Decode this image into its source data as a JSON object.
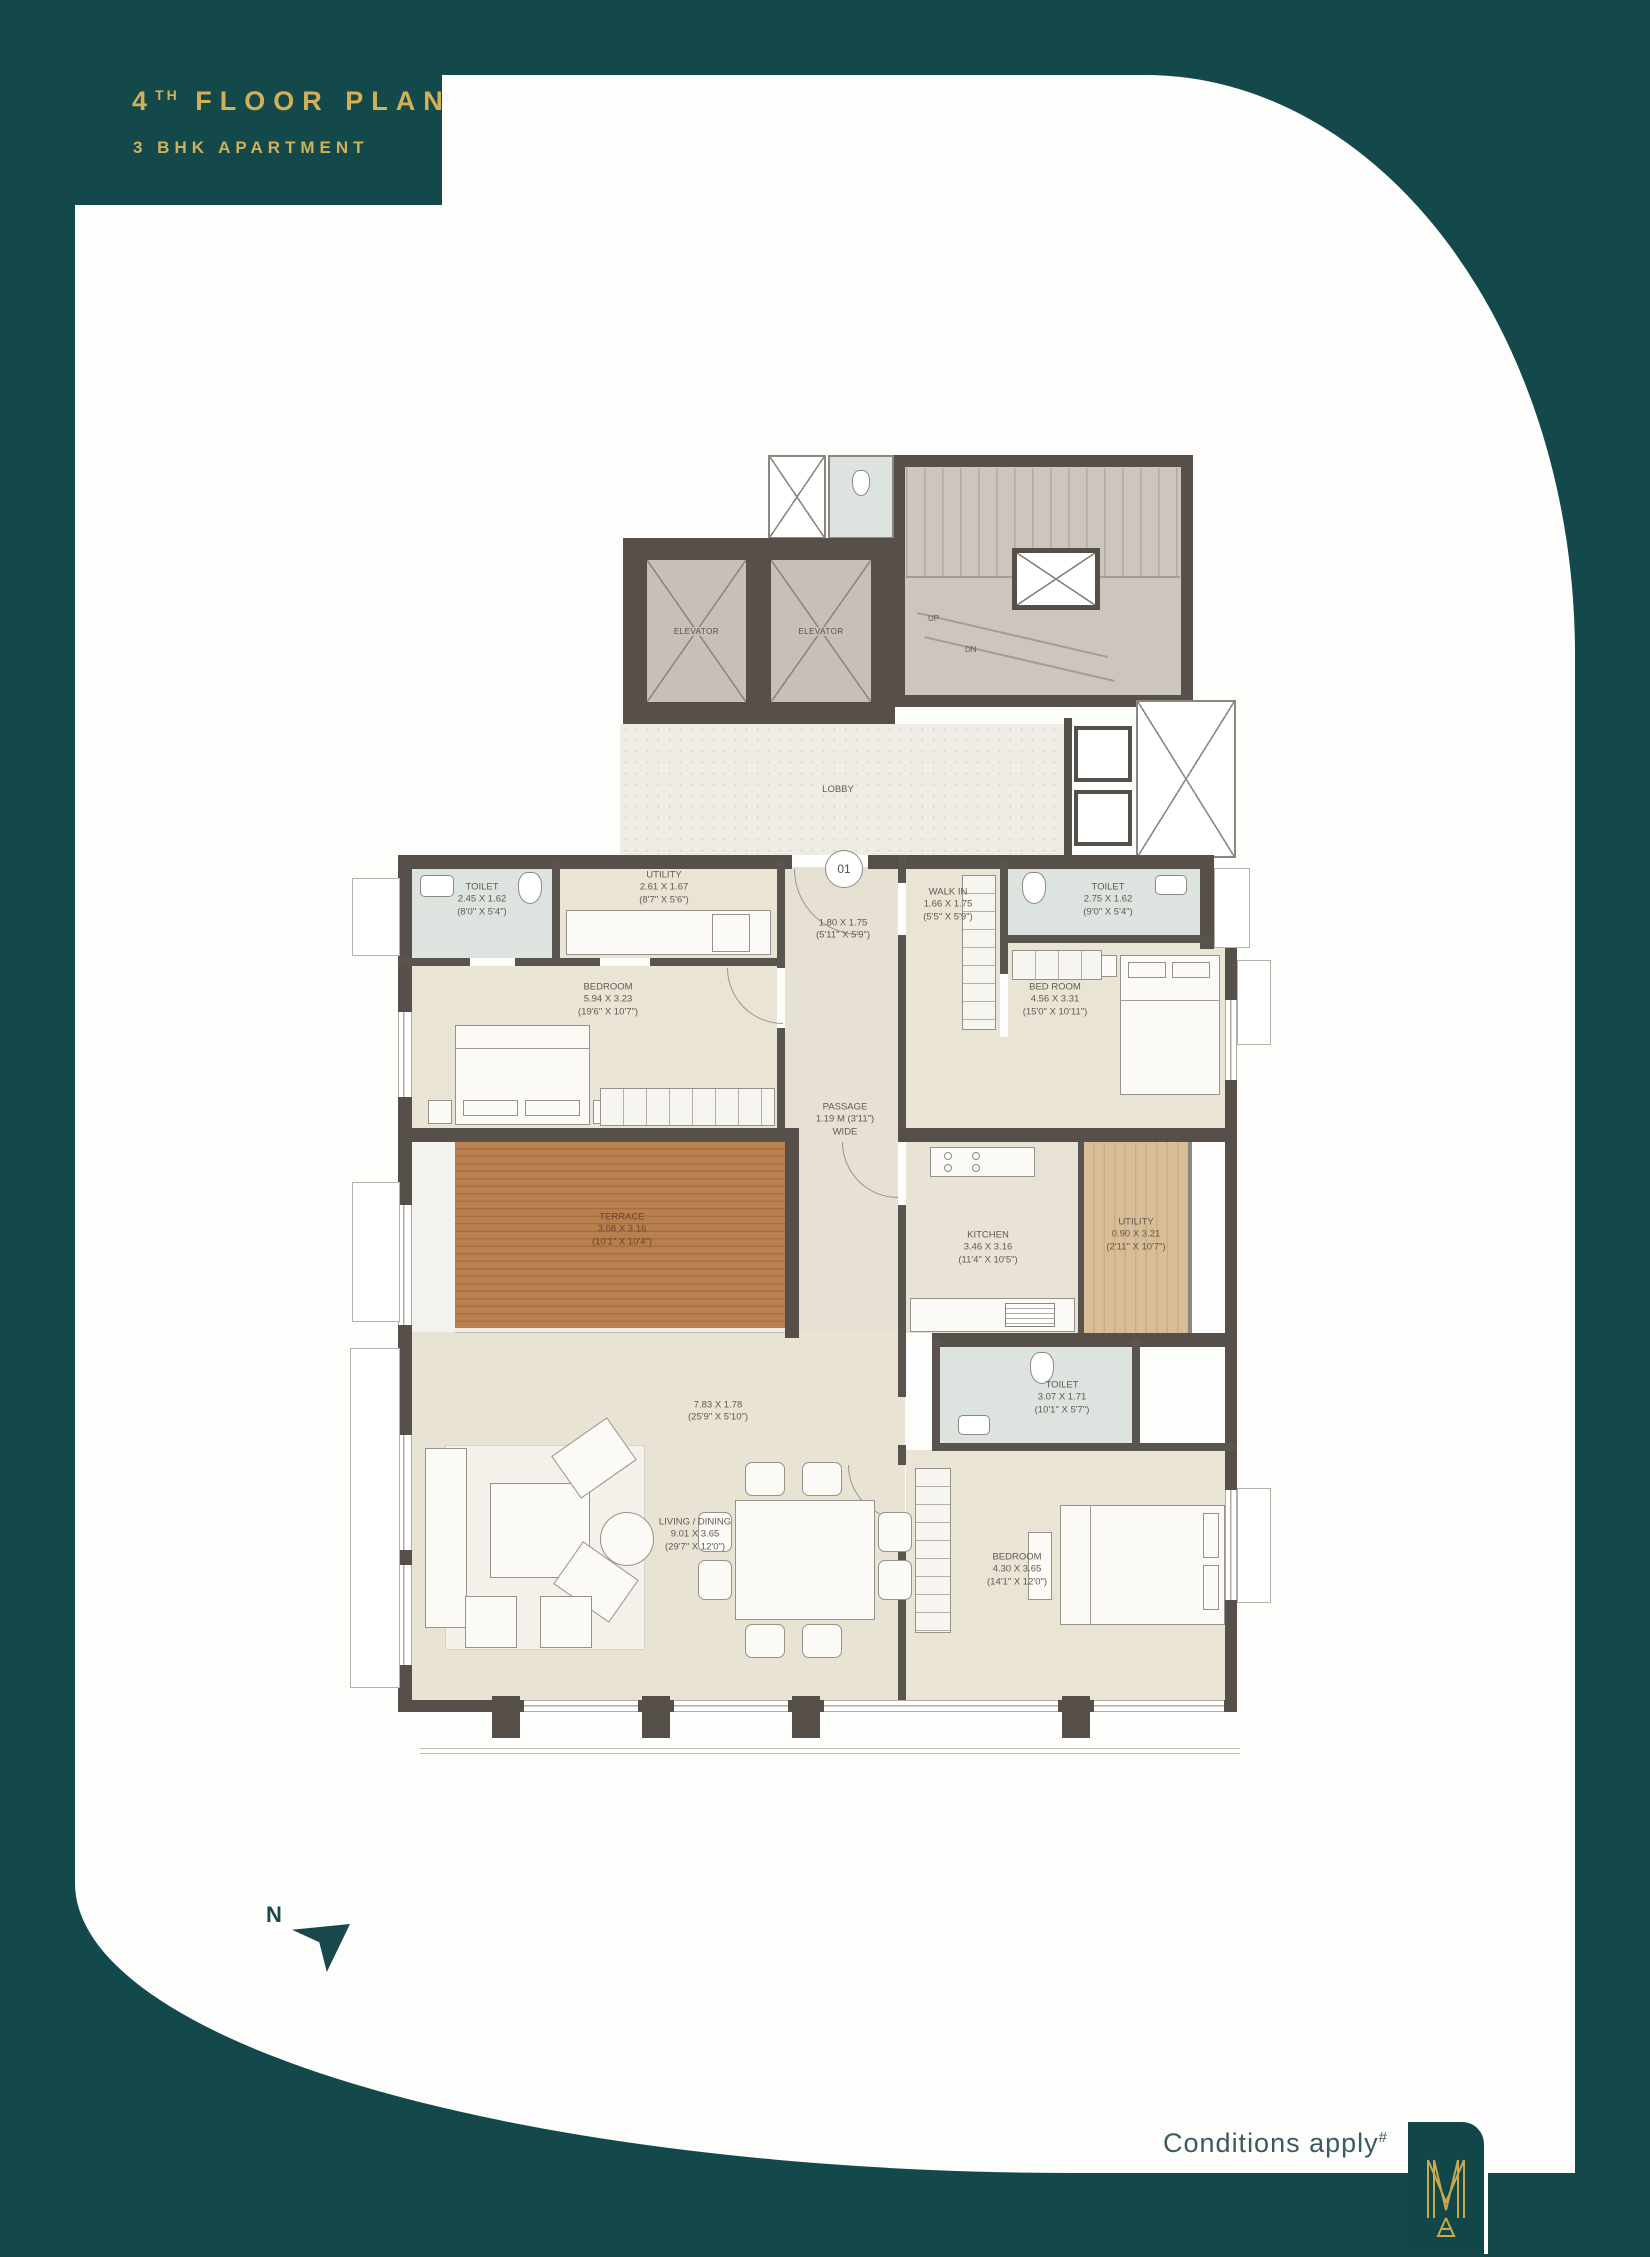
{
  "header": {
    "floor_num": "4",
    "floor_sup": "TH",
    "floor_rest": " FLOOR PLAN",
    "subtitle": "3 BHK APARTMENT"
  },
  "footer": {
    "conditions": "Conditions apply",
    "conditions_sup": "#"
  },
  "compass": {
    "label": "N"
  },
  "core": {
    "elevator1": "ELEVATOR",
    "elevator2": "ELEVATOR",
    "lobby": "LOBBY",
    "up": "UP",
    "dn": "DN",
    "unit_no": "01"
  },
  "rooms": {
    "toilet1": {
      "name": "TOILET",
      "metric": "2.45 X 1.62",
      "imperial": "(8'0\" X 5'4\")"
    },
    "utility1": {
      "name": "UTILITY",
      "metric": "2.61 X 1.67",
      "imperial": "(8'7\" X 5'6\")"
    },
    "bedroom1": {
      "name": "BEDROOM",
      "metric": "5.94 X 3.23",
      "imperial": "(19'6\" X 10'7\")"
    },
    "foyer": {
      "metric": "1.80 X 1.75",
      "imperial": "(5'11\" X 5'9\")"
    },
    "walkin": {
      "name": "WALK IN",
      "metric": "1.66 X 1.75",
      "imperial": "(5'5\" X 5'9\")"
    },
    "toilet2": {
      "name": "TOILET",
      "metric": "2.75 X 1.62",
      "imperial": "(9'0\" X 5'4\")"
    },
    "bedroom2": {
      "name": "BED ROOM",
      "metric": "4.56 X 3.31",
      "imperial": "(15'0\" X 10'11\")"
    },
    "passage": {
      "name": "PASSAGE",
      "metric": "1.19 M (3'11\")",
      "note": "WIDE"
    },
    "terrace": {
      "name": "TERRACE",
      "metric": "3.08 X 3.16",
      "imperial": "(10'1\" X 10'4\")"
    },
    "kitchen": {
      "name": "KITCHEN",
      "metric": "3.46 X 3.16",
      "imperial": "(11'4\" X 10'5\")"
    },
    "utility2": {
      "name": "UTILITY",
      "metric": "0.90 X 3.21",
      "imperial": "(2'11\" X 10'7\")"
    },
    "toilet3": {
      "name": "TOILET",
      "metric": "3.07 X 1.71",
      "imperial": "(10'1\" X 5'7\")"
    },
    "deck": {
      "metric": "7.83 X 1.78",
      "imperial": "(25'9\" X 5'10\")"
    },
    "living": {
      "name": "LIVING / DINING",
      "metric": "9.01 X 3.65",
      "imperial": "(29'7\" X 12'0\")"
    },
    "bedroom3": {
      "name": "BEDROOM",
      "metric": "4.30 X 3.65",
      "imperial": "(14'1\" X 12'0\")"
    }
  },
  "colors": {
    "brand_teal": "#14494b",
    "brand_gold": "#d3b055",
    "wall": "#57504a",
    "floor": "#eae4d5",
    "wet_floor": "#dde4e0",
    "terrace_deck": "#b97f4e"
  }
}
